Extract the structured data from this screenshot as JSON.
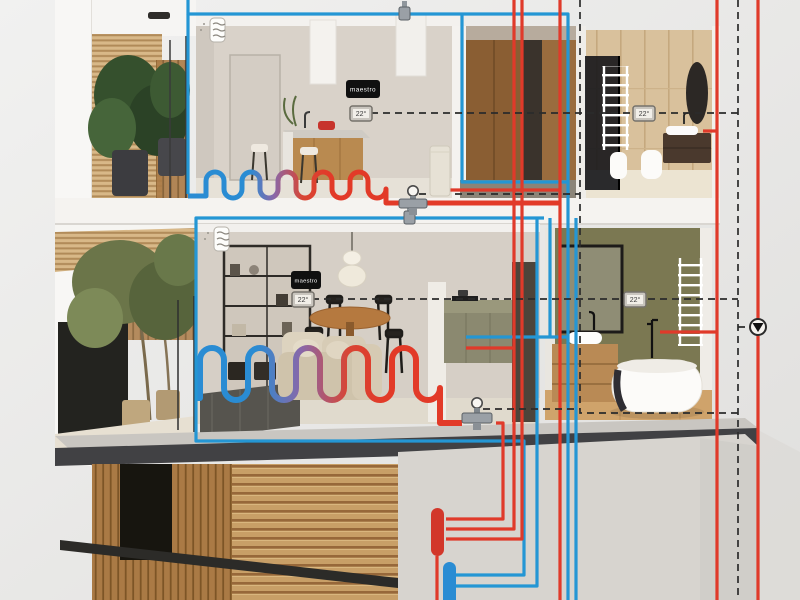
{
  "displays": [
    {
      "label": "maestro"
    },
    {
      "label": "maestro"
    }
  ],
  "thermostats": [
    {
      "value": "22°"
    },
    {
      "value": "22°"
    },
    {
      "value": "22°"
    },
    {
      "value": "22°"
    }
  ],
  "colors": {
    "hot_water": "#e03a2a",
    "cold_water": "#2496d4",
    "control_wire": "#2b2b2b"
  }
}
